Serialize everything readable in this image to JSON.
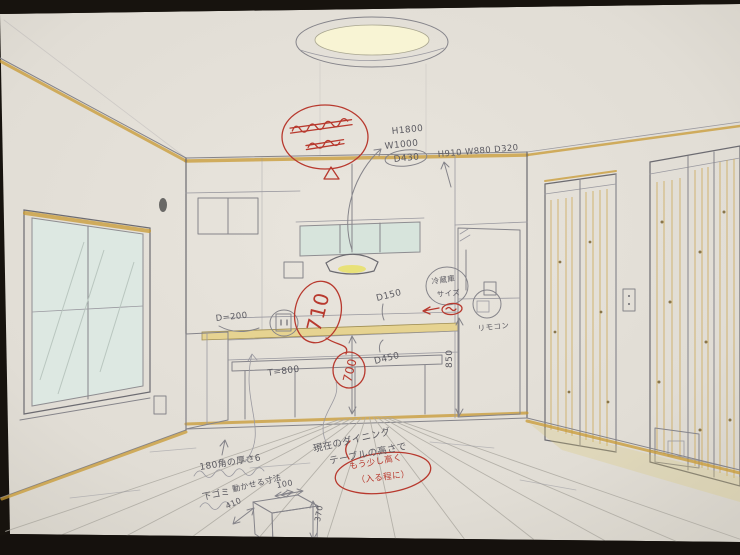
{
  "annotations": {
    "pencil": {
      "pendant_h": "H1800",
      "pendant_w": "W1000",
      "pendant_d": "D430",
      "cabinet_dims": "H910 W880 D320",
      "fridge_label_1": "冷蔵庫",
      "fridge_label_2": "サイズ",
      "remote_label": "リモコン",
      "depth_150": "D150",
      "depth_450": "D450",
      "depth_200": "D=200",
      "thickness_800": "T=800",
      "height_850": "850",
      "corner_note": "180角の厚さ6",
      "under_note": "下ゴミ",
      "clearance_note": "動かせる寸法",
      "clearance_100": "100",
      "box_width_410": "410",
      "box_height_370": "370",
      "dining_note_1": "現在のダイニング",
      "dining_note_2": "テーブルの高さで"
    },
    "red": {
      "height_710": "710",
      "height_700": "700",
      "note_1": "もう少し高く",
      "note_2": "（入る程に）"
    }
  },
  "colors": {
    "paper": "#e4e0d8",
    "pencil": "#85848a",
    "ink_red": "#b8392e",
    "accent_ochre": "#c89a33",
    "wood_yellow": "#f2e9b6",
    "glass_blue": "#dde8e2",
    "lamp_yellow": "#f2ecb2"
  }
}
